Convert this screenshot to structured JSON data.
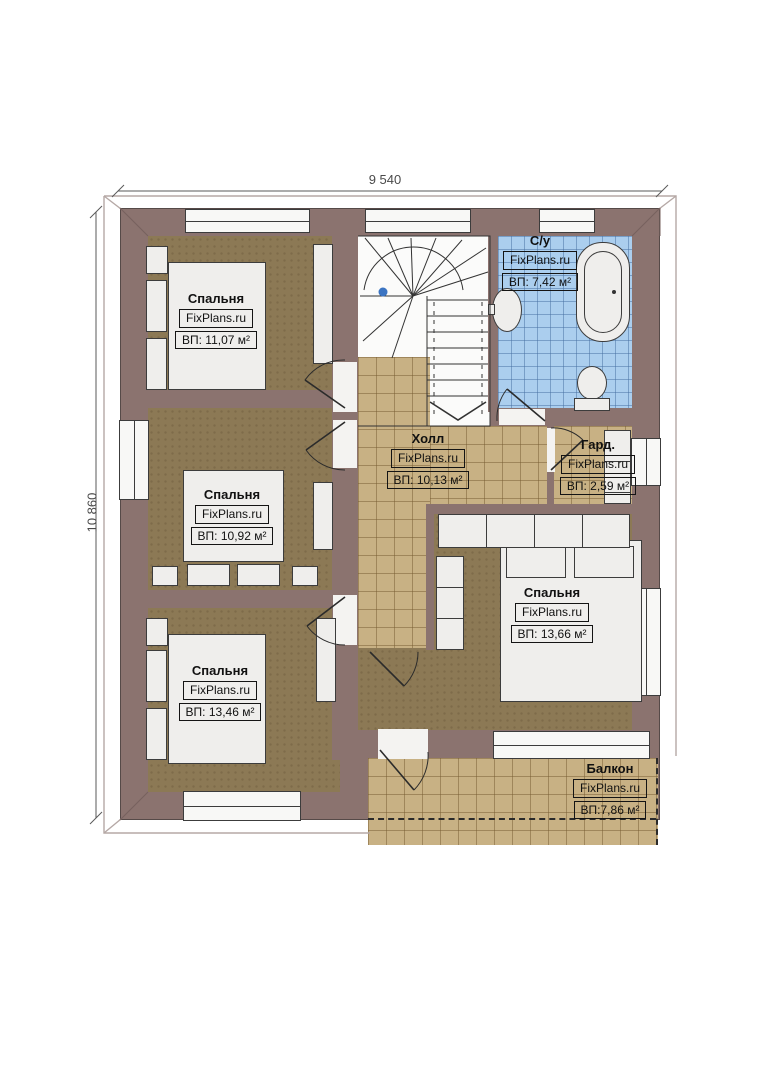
{
  "plan_title": "Floor plan (second floor)",
  "dimensions": {
    "top": "9 540",
    "left": "10 860"
  },
  "watermark": "FixPlans.ru",
  "rooms": {
    "bedroom1": {
      "name": "Спальня",
      "area": "ВП: 11,07 м²"
    },
    "bathroom": {
      "name": "С/у",
      "area": "ВП: 7,42 м²"
    },
    "bedroom2": {
      "name": "Спальня",
      "area": "ВП: 10,92 м²"
    },
    "hall": {
      "name": "Холл",
      "area": "ВП: 10,13 м²"
    },
    "wardrobe": {
      "name": "Гард.",
      "area": "ВП: 2,59 м²"
    },
    "bedroom4": {
      "name": "Спальня",
      "area": "ВП: 13,66 м²"
    },
    "bedroom3": {
      "name": "Спальня",
      "area": "ВП: 13,46 м²"
    },
    "balcony": {
      "name": "Балкон",
      "area": "ВП:7,86 м²"
    }
  },
  "colors": {
    "wall": "#8b736f",
    "bedroom_floor": "#8c7955",
    "tile_floor": "#c8b184",
    "bathroom_tile": "#abceee",
    "marker_dot": "#3b74c2"
  }
}
